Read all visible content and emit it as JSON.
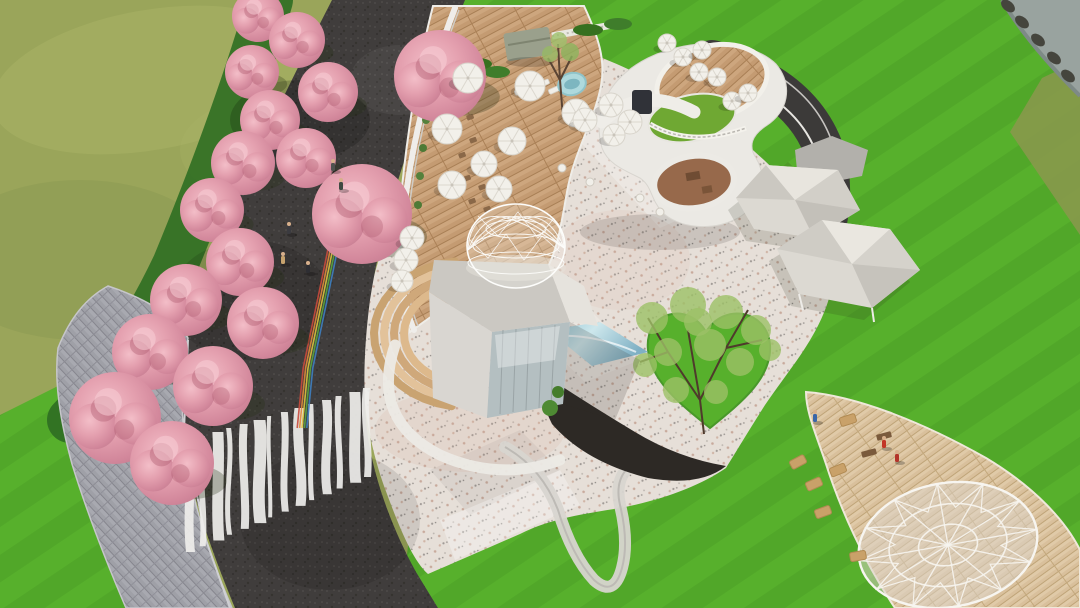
{
  "image": {
    "kind": "aerial-architectural-rendering",
    "description": "Bird's-eye 3D rendering of a landscaped leisure park: cherry-blossom allee along a dark path with wavy zebra crossing and rainbow stripe, timber cafe deck with parasols, curved white pavilion with green-roof courtyard and rooftop terrace, concrete pavilion with geodesic dome skylight, gravel plaza with heart-shaped tree lawn, tensile canopies, pond, and a timber boardwalk with ground geodesic lattice.",
    "width": 1080,
    "height": 608
  },
  "palette": {
    "meadow": "#9aa55a",
    "meadow_dark": "#8b984d",
    "lawn": "#57b02c",
    "hedge": "#2f6e22",
    "pond": "#99a39f",
    "rock": "#45453d",
    "asphalt": "#403d3c",
    "paver": "#9fa0a7",
    "terrazzo": "#e6dfd8",
    "wood": "#c49b72",
    "wood_light": "#d9c09c",
    "building_white": "#ebe9e4",
    "building_shadow": "#cfccc6",
    "green_roof": "#6fa833",
    "pool": "#aed9dd",
    "glass": "#7fb7c9",
    "canopy": "#dcd9d2",
    "canopy_gray": "#b2b0ab",
    "blossom": "#e09dab",
    "steps_tan": "#d7b287",
    "mulch": "#2d2925",
    "track": "#3c3a39",
    "terrace_brown": "#97694b",
    "zebra_white": "#efeeec",
    "dome_wire": "#fdfdfb"
  },
  "scene_elements": [
    "meadow",
    "striped-lawn",
    "pond",
    "cherry-blossom-allee",
    "asphalt-walkway",
    "zebra-crosswalk",
    "rainbow-path",
    "paver-path",
    "timber-deck-terrace",
    "parasols",
    "curved-pavilion",
    "green-roof-courtyard",
    "rooftop-terrace",
    "swimming-pool",
    "pergola",
    "concrete-pavilion",
    "geodesic-dome-skylight",
    "curved-steps",
    "glass-water-feature",
    "gravel-plaza",
    "heart-lawn-tree",
    "tensile-canopies",
    "running-track",
    "timber-boardwalk",
    "ground-geodesic-lattice",
    "hay-bales",
    "visitors",
    "loop-path"
  ],
  "counts": {
    "cherry_trees": 17,
    "parasols": 22,
    "tensile_canopies": 3,
    "geodesic_domes": 2,
    "people": 8,
    "hay_bales": 6
  },
  "cherry_trees": [
    [
      258,
      16,
      26
    ],
    [
      297,
      40,
      28
    ],
    [
      440,
      76,
      46
    ],
    [
      252,
      72,
      27
    ],
    [
      328,
      92,
      30
    ],
    [
      270,
      120,
      30
    ],
    [
      243,
      163,
      32
    ],
    [
      306,
      158,
      30
    ],
    [
      362,
      214,
      50
    ],
    [
      212,
      210,
      32
    ],
    [
      240,
      262,
      34
    ],
    [
      186,
      300,
      36
    ],
    [
      263,
      323,
      36
    ],
    [
      150,
      352,
      38
    ],
    [
      213,
      386,
      40
    ],
    [
      115,
      418,
      46
    ],
    [
      172,
      463,
      42
    ]
  ],
  "parasols_deck": [
    [
      468,
      78,
      15
    ],
    [
      530,
      86,
      15
    ],
    [
      576,
      113,
      14
    ],
    [
      447,
      129,
      15
    ],
    [
      512,
      141,
      14
    ],
    [
      484,
      164,
      13
    ],
    [
      452,
      185,
      14
    ],
    [
      499,
      189,
      13
    ],
    [
      585,
      120,
      12
    ],
    [
      611,
      105,
      12
    ],
    [
      630,
      122,
      12
    ],
    [
      614,
      135,
      11
    ],
    [
      412,
      238,
      12
    ],
    [
      406,
      260,
      12
    ],
    [
      402,
      281,
      11
    ]
  ],
  "parasols_rooftop": [
    [
      667,
      43,
      9
    ],
    [
      683,
      57,
      9
    ],
    [
      702,
      50,
      9
    ],
    [
      699,
      72,
      9
    ],
    [
      717,
      77,
      9
    ],
    [
      732,
      101,
      9
    ],
    [
      748,
      93,
      9
    ]
  ],
  "people": [
    [
      289,
      233,
      "#3b3b40"
    ],
    [
      283,
      263,
      "#c7a36e"
    ],
    [
      308,
      272,
      "#2e2e33"
    ],
    [
      333,
      170,
      "#50524f"
    ],
    [
      341,
      189,
      "#3f4a42"
    ],
    [
      815,
      421,
      "#3a66a8"
    ],
    [
      884,
      447,
      "#c23527"
    ],
    [
      897,
      461,
      "#b3342a"
    ]
  ],
  "hay_bales": [
    [
      848,
      420,
      -18
    ],
    [
      798,
      462,
      -28
    ],
    [
      814,
      484,
      -24
    ],
    [
      823,
      512,
      -20
    ],
    [
      858,
      556,
      -10
    ],
    [
      838,
      470,
      -22
    ]
  ],
  "benches": [
    [
      884,
      436
    ],
    [
      869,
      453
    ],
    [
      316,
      171
    ]
  ],
  "zebra": {
    "widths": [
      9,
      6,
      11,
      5,
      8,
      12,
      4,
      7,
      10,
      5,
      9,
      6,
      11,
      7
    ],
    "wiggles": [
      3,
      -4,
      2,
      5,
      -3,
      4,
      -2,
      3,
      -5,
      2,
      4,
      -3,
      2,
      -4
    ]
  },
  "rainbow_colors": [
    "#c94a3c",
    "#de8a3a",
    "#d9c23e",
    "#5aa53e",
    "#3e7fc1"
  ],
  "deck_furniture": [
    [
      448,
      62
    ],
    [
      460,
      70
    ],
    [
      447,
      86
    ],
    [
      462,
      94
    ],
    [
      450,
      108
    ],
    [
      466,
      116
    ],
    [
      453,
      130
    ],
    [
      469,
      139
    ],
    [
      458,
      154
    ],
    [
      473,
      162
    ],
    [
      463,
      177
    ],
    [
      478,
      186
    ],
    [
      468,
      200
    ],
    [
      483,
      208
    ]
  ],
  "loungers": [
    [
      524,
      78
    ],
    [
      536,
      84
    ],
    [
      548,
      90
    ],
    [
      514,
      91
    ]
  ],
  "plaza_tables": [
    [
      562,
      168
    ],
    [
      590,
      182
    ],
    [
      640,
      198
    ],
    [
      660,
      212
    ]
  ],
  "heart_tree_foliage": [
    [
      652,
      318,
      16
    ],
    [
      688,
      305,
      18
    ],
    [
      726,
      312,
      17
    ],
    [
      756,
      330,
      15
    ],
    [
      668,
      352,
      14
    ],
    [
      710,
      345,
      16
    ],
    [
      740,
      362,
      14
    ],
    [
      676,
      390,
      13
    ],
    [
      716,
      392,
      12
    ],
    [
      645,
      365,
      12
    ],
    [
      770,
      350,
      11
    ],
    [
      698,
      322,
      14
    ]
  ],
  "pond_rocks": [
    [
      1008,
      6
    ],
    [
      1022,
      22
    ],
    [
      1038,
      40
    ],
    [
      1054,
      58
    ],
    [
      1068,
      76
    ]
  ]
}
